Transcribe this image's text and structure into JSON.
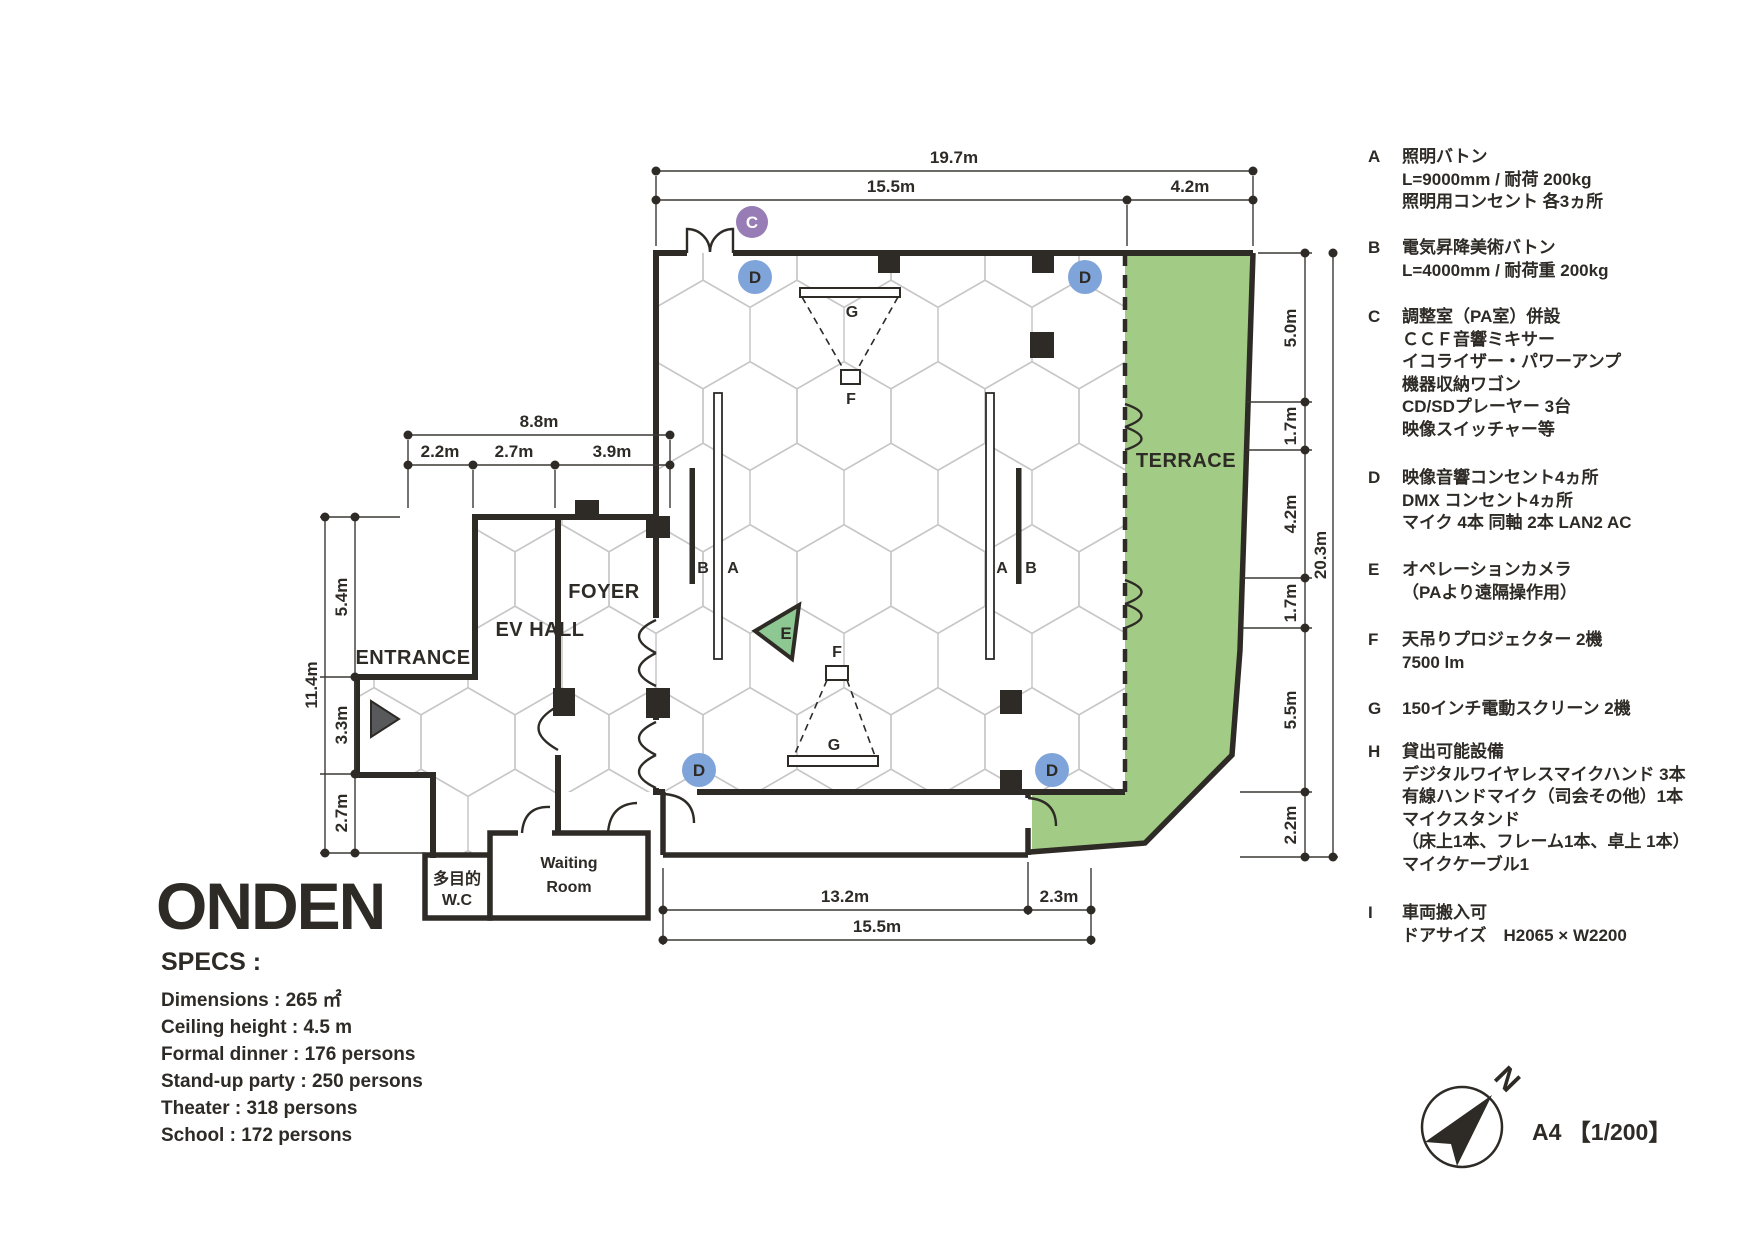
{
  "title": "ONDEN",
  "specs": {
    "heading": "SPECS :",
    "lines": [
      "Dimensions : 265 ㎡",
      "Ceiling height : 4.5 m",
      "Formal dinner : 176 persons",
      "Stand-up party : 250 persons",
      "Theater : 318 persons",
      "School : 172 persons"
    ]
  },
  "rooms": {
    "entrance": "ENTRANCE",
    "ev_hall": "EV HALL",
    "foyer": "FOYER",
    "terrace": "TERRACE",
    "wc_line1": "多目的",
    "wc_line2": "W.C",
    "waiting_line1": "Waiting",
    "waiting_line2": "Room"
  },
  "markers": {
    "a": "A",
    "b": "B",
    "c": "C",
    "d": "D",
    "e": "E",
    "f": "F",
    "g": "G"
  },
  "dimensions": {
    "top": {
      "total": "19.7m",
      "hall": "15.5m",
      "terrace": "4.2m"
    },
    "upper_left": {
      "total": "8.8m",
      "segments": [
        "2.2m",
        "2.7m",
        "3.9m"
      ]
    },
    "left": {
      "total": "11.4m",
      "segments": [
        "5.4m",
        "3.3m",
        "2.7m"
      ]
    },
    "right": {
      "total": "20.3m",
      "segments": [
        "5.0m",
        "1.7m",
        "4.2m",
        "1.7m",
        "5.5m",
        "2.2m"
      ]
    },
    "bottom": {
      "segments": [
        "13.2m",
        "2.3m"
      ],
      "total": "15.5m"
    }
  },
  "legend": {
    "items": [
      {
        "letter": "A",
        "lines": [
          "照明バトン",
          "L=9000mm / 耐荷 200kg",
          "照明用コンセント 各3ヵ所"
        ]
      },
      {
        "letter": "B",
        "lines": [
          "電気昇降美術バトン",
          "L=4000mm / 耐荷重 200kg"
        ]
      },
      {
        "letter": "C",
        "lines": [
          "調整室（PA室）併設",
          "ＣＣＦ音響ミキサー",
          "イコライザー・パワーアンプ",
          "機器収納ワゴン",
          "CD/SDプレーヤー 3台",
          "映像スイッチャー等"
        ]
      },
      {
        "letter": "D",
        "lines": [
          "映像音響コンセント4ヵ所",
          "DMX コンセント4ヵ所",
          "マイク 4本 同軸 2本 LAN2 AC"
        ]
      },
      {
        "letter": "E",
        "lines": [
          "オペレーションカメラ",
          "（PAより遠隔操作用）"
        ]
      },
      {
        "letter": "F",
        "lines": [
          "天吊りプロジェクター 2機",
          "7500 lm"
        ]
      },
      {
        "letter": "G",
        "lines": [
          "150インチ電動スクリーン 2機"
        ]
      },
      {
        "letter": "H",
        "lines": [
          "貸出可能設備",
          "デジタルワイヤレスマイクハンド 3本",
          "有線ハンドマイク（司会その他）1本",
          "マイクスタンド",
          "（床上1本、フレーム1本、卓上 1本）",
          "マイクケーブル1"
        ]
      },
      {
        "letter": "I",
        "lines": [
          "車両搬入可",
          "ドアサイズ　H2065 × W2200"
        ]
      }
    ]
  },
  "compass": {
    "north": "N",
    "scale": "A4 【1/200】"
  },
  "colors": {
    "ink": "#2e2a26",
    "terrace_green": "#a2cc85",
    "marker_blue": "#7fa4da",
    "marker_purple": "#977cb5",
    "camera_green": "#8dc792",
    "hex_grid": "#c7c7c7",
    "entrance_arrow": "#58595b"
  }
}
